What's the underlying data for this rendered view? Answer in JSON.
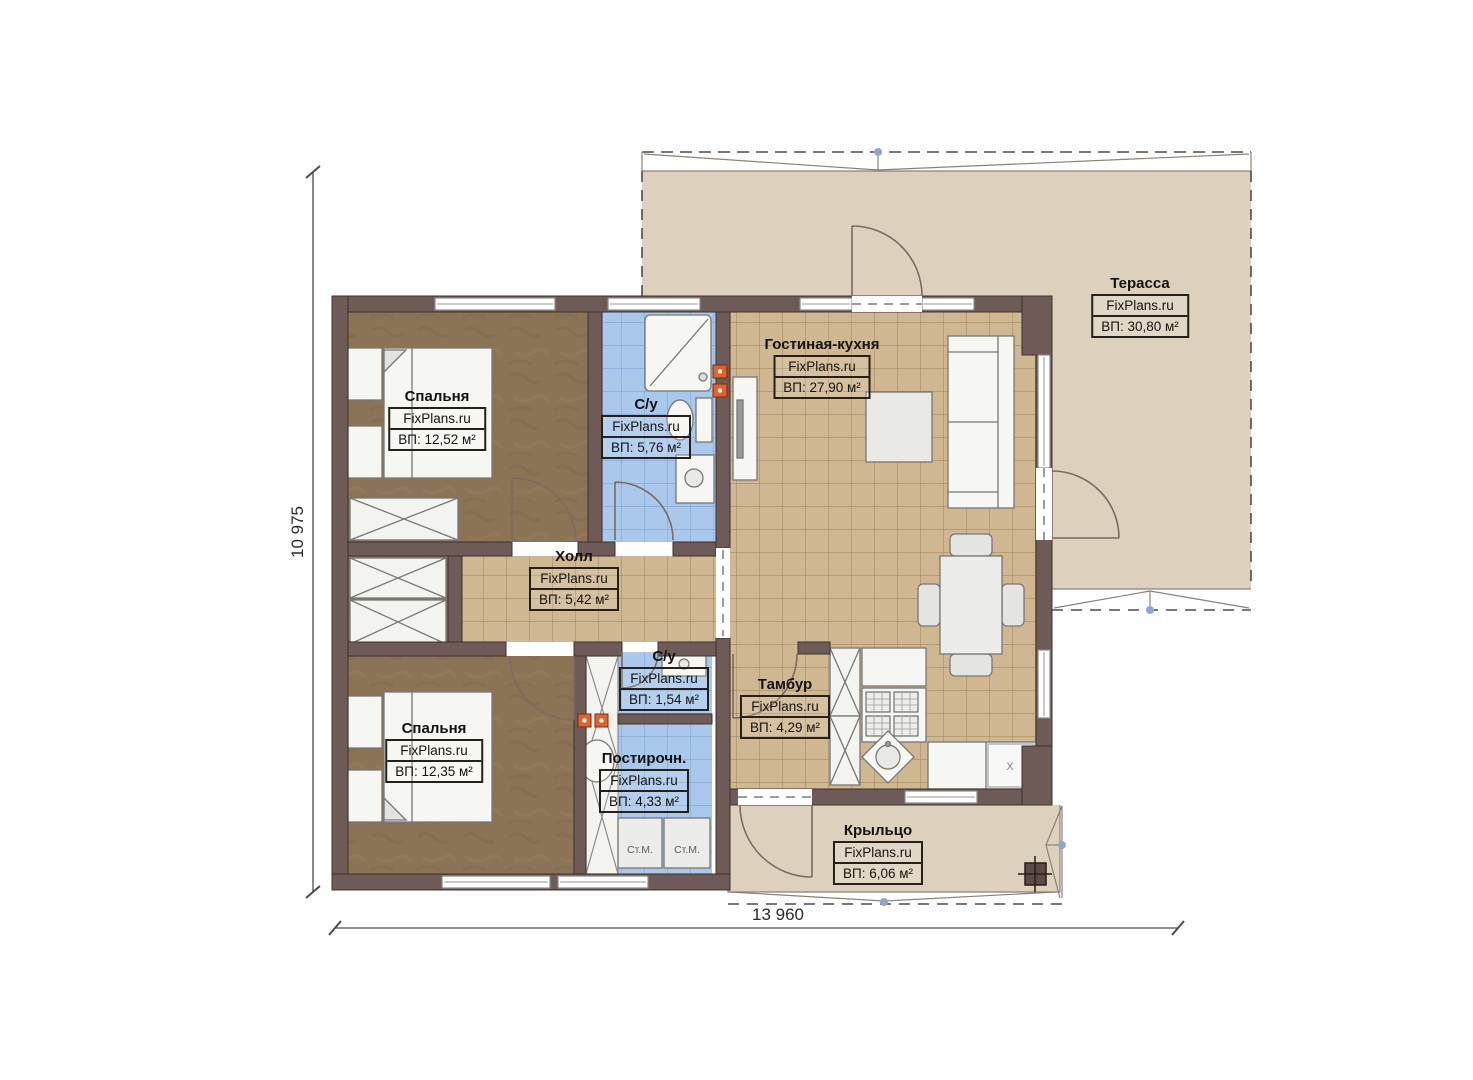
{
  "watermark": "FixPlans.ru",
  "rooms": [
    {
      "id": "bedroom-top",
      "name": "Спальня",
      "watermark": "FixPlans.ru",
      "area": "ВП: 12,52 м²"
    },
    {
      "id": "bathroom-top",
      "name": "С/у",
      "watermark": "FixPlans.ru",
      "area": "ВП: 5,76 м²"
    },
    {
      "id": "living-kitchen",
      "name": "Гостиная-кухня",
      "watermark": "FixPlans.ru",
      "area": "ВП: 27,90 м²"
    },
    {
      "id": "terrace",
      "name": "Терасса",
      "watermark": "FixPlans.ru",
      "area": "ВП: 30,80 м²"
    },
    {
      "id": "hall",
      "name": "Холл",
      "watermark": "FixPlans.ru",
      "area": "ВП: 5,42 м²"
    },
    {
      "id": "bathroom-small",
      "name": "С/у",
      "watermark": "FixPlans.ru",
      "area": "ВП: 1,54 м²"
    },
    {
      "id": "tambour",
      "name": "Тамбур",
      "watermark": "FixPlans.ru",
      "area": "ВП: 4,29 м²"
    },
    {
      "id": "bedroom-bottom",
      "name": "Спальня",
      "watermark": "FixPlans.ru",
      "area": "ВП: 12,35 м²"
    },
    {
      "id": "laundry",
      "name": "Постирочн.",
      "watermark": "FixPlans.ru",
      "area": "ВП: 4,33 м²"
    },
    {
      "id": "porch",
      "name": "Крыльцо",
      "watermark": "FixPlans.ru",
      "area": "ВП: 6,06 м²"
    }
  ],
  "appliances": {
    "washer_left": "Ст.М.",
    "washer_right": "Ст.М.",
    "storage_mark": "x"
  },
  "dimensions": {
    "bottom": "13 960",
    "left": "10 975"
  },
  "palette": {
    "wall": "#6e5b57",
    "tile_tan": "#cfb791",
    "tile_blue": "#a9c8ec",
    "floor_brown": "#8b7355",
    "terrace_beige": "#ddd1bd",
    "accent_orange": "#e2622b",
    "roof_node_blue": "#8fa7c8"
  }
}
